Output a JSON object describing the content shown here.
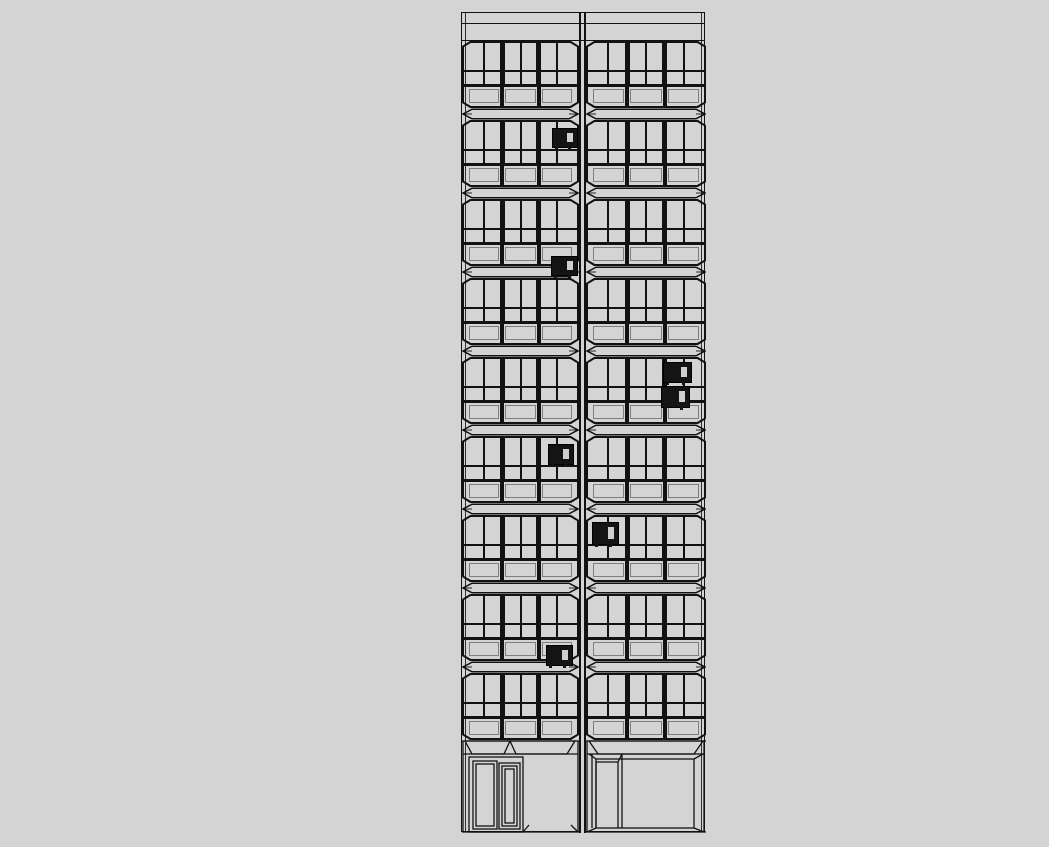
{
  "scene": {
    "type": "architectural-elevation-line-drawing",
    "description": "Black line-work front elevation of a 10-storey two-bay slab block on a plain grey background; nine identical glazed floors over a ground floor with entrance doors; several small dark air-conditioning units mounted on the glazing."
  },
  "canvas": {
    "width": 1049,
    "height": 847,
    "background": "#d4d4d4",
    "line_color": "#121212"
  },
  "building": {
    "x": 461,
    "y": 12,
    "width": 244,
    "height": 820,
    "left_bay_width": 117,
    "divider_width": 7,
    "right_bay_width": 120,
    "parapet": {
      "band1_height": 11,
      "band2_height": 17
    },
    "typical_floors": 9,
    "floor": {
      "window_band_height": 67,
      "slab_band_height": 12,
      "groups_per_bay": 3,
      "panes_per_group": 2,
      "rows": [
        "upper-glazing",
        "transom-lights",
        "spandrel-panels"
      ]
    },
    "ground": {
      "height": 93,
      "canopy_height": 14,
      "left_bay": "recessed entrance with double door (wide leaf + narrow leaf)",
      "right_bay": "recessed storefront panel with single door at left"
    }
  },
  "ac_units": [
    {
      "id": "ac-floor2-left",
      "floor": 2,
      "bay": "left",
      "x": 90,
      "y": 115,
      "w": 26,
      "h": 20
    },
    {
      "id": "ac-floor3-left",
      "floor": 3,
      "bay": "left",
      "x": 89,
      "y": 243,
      "w": 27,
      "h": 20
    },
    {
      "id": "ac-floor5-right-upper",
      "floor": 5,
      "bay": "right",
      "x": 201,
      "y": 349,
      "w": 29,
      "h": 21
    },
    {
      "id": "ac-floor5-right-lower",
      "floor": 5,
      "bay": "right",
      "x": 199,
      "y": 373,
      "w": 29,
      "h": 22
    },
    {
      "id": "ac-floor6-left",
      "floor": 6,
      "bay": "left",
      "x": 86,
      "y": 431,
      "w": 26,
      "h": 21
    },
    {
      "id": "ac-floor7-right",
      "floor": 7,
      "bay": "right",
      "x": 130,
      "y": 509,
      "w": 27,
      "h": 23
    },
    {
      "id": "ac-floor8-left",
      "floor": 8,
      "bay": "left",
      "x": 84,
      "y": 632,
      "w": 27,
      "h": 21
    }
  ]
}
